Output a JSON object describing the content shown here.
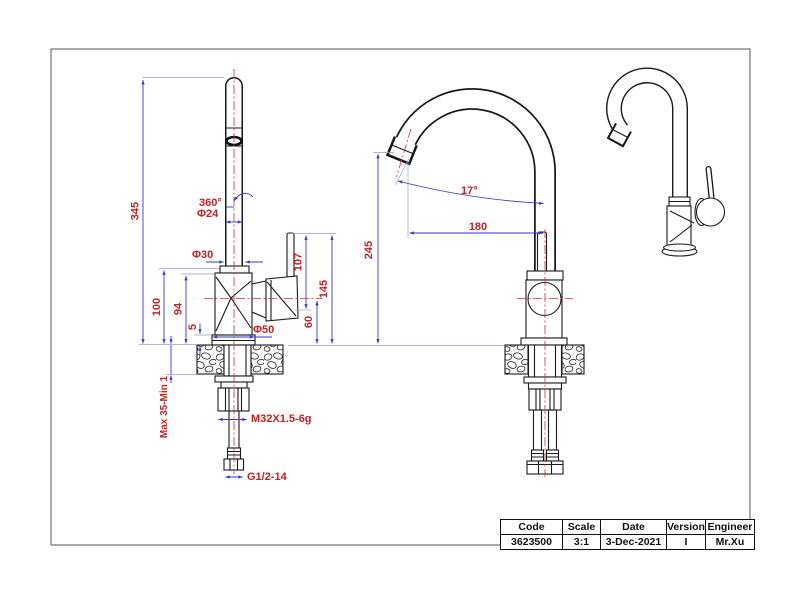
{
  "labels": {
    "len_345": "345",
    "rot_360": "360°",
    "dia_24": "Φ24",
    "dia_30": "Φ30",
    "len_100": "100",
    "len_94": "94",
    "len_5": "5",
    "dia_50": "Φ50",
    "len_60": "60",
    "len_107": "107",
    "len_145": "145",
    "mount_thickness": "Max 35-Min 1",
    "thread_m32": "M32X1.5-6g",
    "thread_g12": "G1/2-14",
    "ang_17": "17°",
    "len_180": "180",
    "len_245": "245"
  },
  "title_block": {
    "headers": [
      "Code",
      "Scale",
      "Date",
      "Version",
      "Engineer"
    ],
    "values": [
      "3623500",
      "3:1",
      "3-Dec-2021",
      "I",
      "Mr.Xu"
    ]
  },
  "colors": {
    "dimension_line": "#3a3ac8",
    "extension_line": "#9a9ad2",
    "dimension_text": "#c42222",
    "centerline": "#cc3333",
    "outline": "#1a1a1a"
  }
}
